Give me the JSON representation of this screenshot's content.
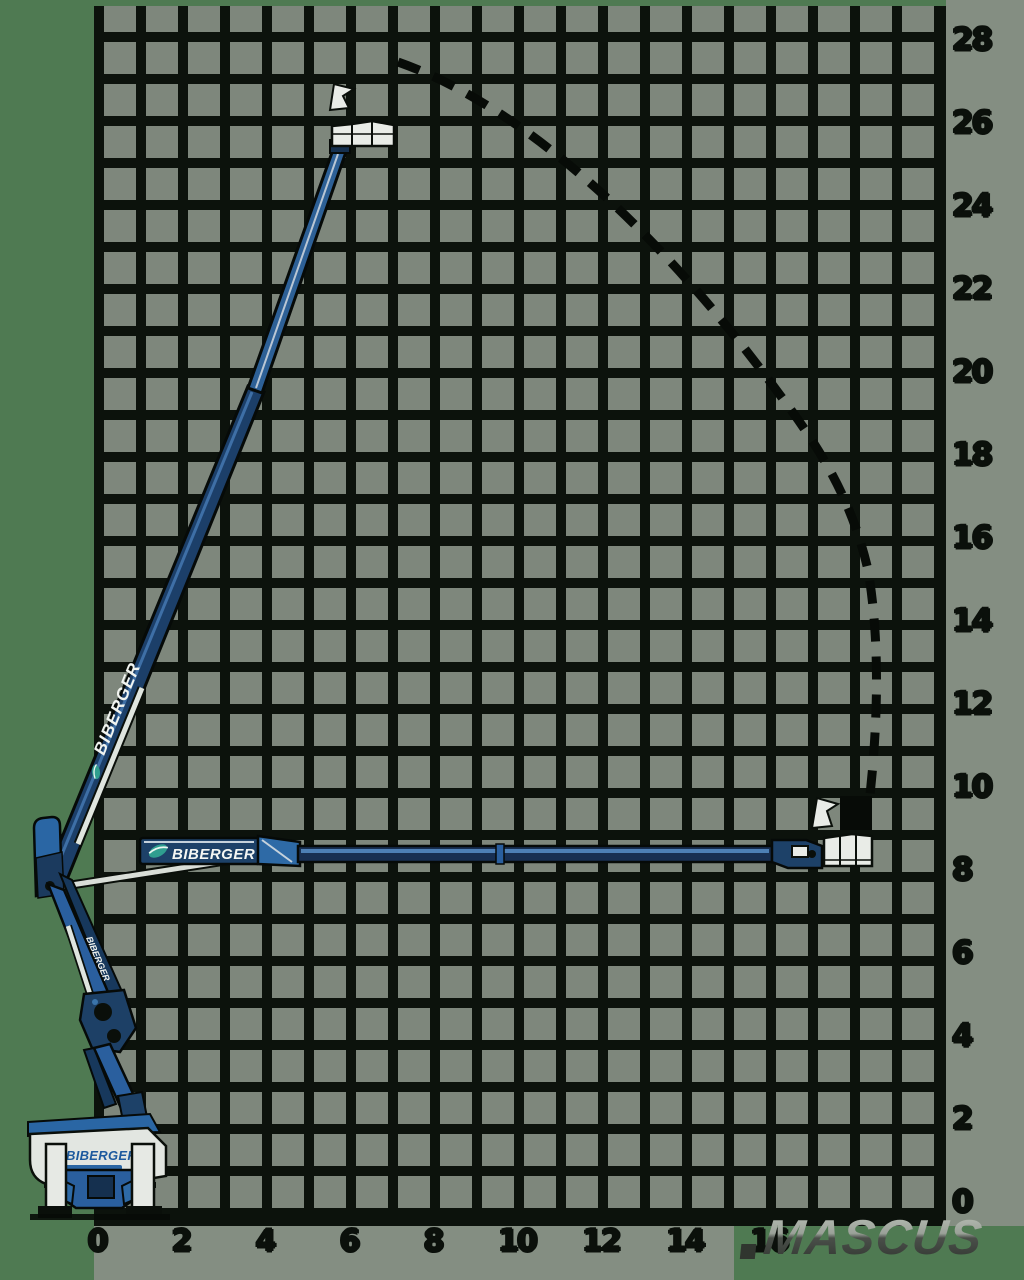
{
  "axes": {
    "y_right": {
      "labels": [
        "28",
        "26",
        "24",
        "22",
        "20",
        "18",
        "16",
        "14",
        "12",
        "10",
        "8",
        "6",
        "4",
        "2",
        "0"
      ]
    },
    "x_bottom": {
      "labels": [
        "0",
        "2",
        "4",
        "6",
        "8",
        "10",
        "12",
        "14",
        "16"
      ]
    }
  },
  "branding": {
    "boom_vertical_label": "BIBERGER",
    "boom_horizontal_label": "BIBERGER",
    "arm_label": "BIBERGER",
    "chassis_label": "BIBERGER"
  },
  "watermark": {
    "text": "MASCUS"
  },
  "colors": {
    "background_green": "#4f7a52",
    "grid_cell_grey": "#7e877c",
    "grid_line_black": "#0c120c",
    "label_strip_grey": "#848e82",
    "boom_navy": "#1c3f69",
    "boom_blue": "#2a5f9e",
    "boom_highlight_blue": "#4d7fb5",
    "cylinder_silver": "#dfe5df",
    "basket_white": "#e9ece7",
    "leaf_teal": "#2f9e8f",
    "chassis_logo_blue": "#1d5a9e",
    "envelope_black": "#070b07"
  },
  "chart_data": {
    "type": "line",
    "title": "",
    "xlabel": "",
    "ylabel": "",
    "x_ticks": [
      0,
      2,
      4,
      6,
      8,
      10,
      12,
      14,
      16
    ],
    "y_ticks": [
      28,
      26,
      24,
      22,
      20,
      18,
      16,
      14,
      12,
      10,
      8,
      6,
      4,
      2,
      0
    ],
    "xlim": [
      0,
      20
    ],
    "ylim": [
      0,
      29
    ],
    "grid": true,
    "legend": "none",
    "series": [
      {
        "name": "working-envelope-boundary",
        "style": "dashed",
        "points": [
          [
            7.3,
            27.5
          ],
          [
            9.5,
            26.3
          ],
          [
            12.0,
            25.0
          ],
          [
            14.5,
            22.3
          ],
          [
            16.6,
            19.6
          ],
          [
            17.4,
            18.0
          ],
          [
            18.3,
            15.1
          ],
          [
            18.6,
            12.5
          ],
          [
            18.5,
            10.1
          ]
        ]
      },
      {
        "name": "platform-at-max-height",
        "points": [
          [
            6.4,
            25.9
          ]
        ]
      },
      {
        "name": "platform-at-max-outreach",
        "points": [
          [
            17.9,
            8.6
          ]
        ]
      }
    ]
  }
}
